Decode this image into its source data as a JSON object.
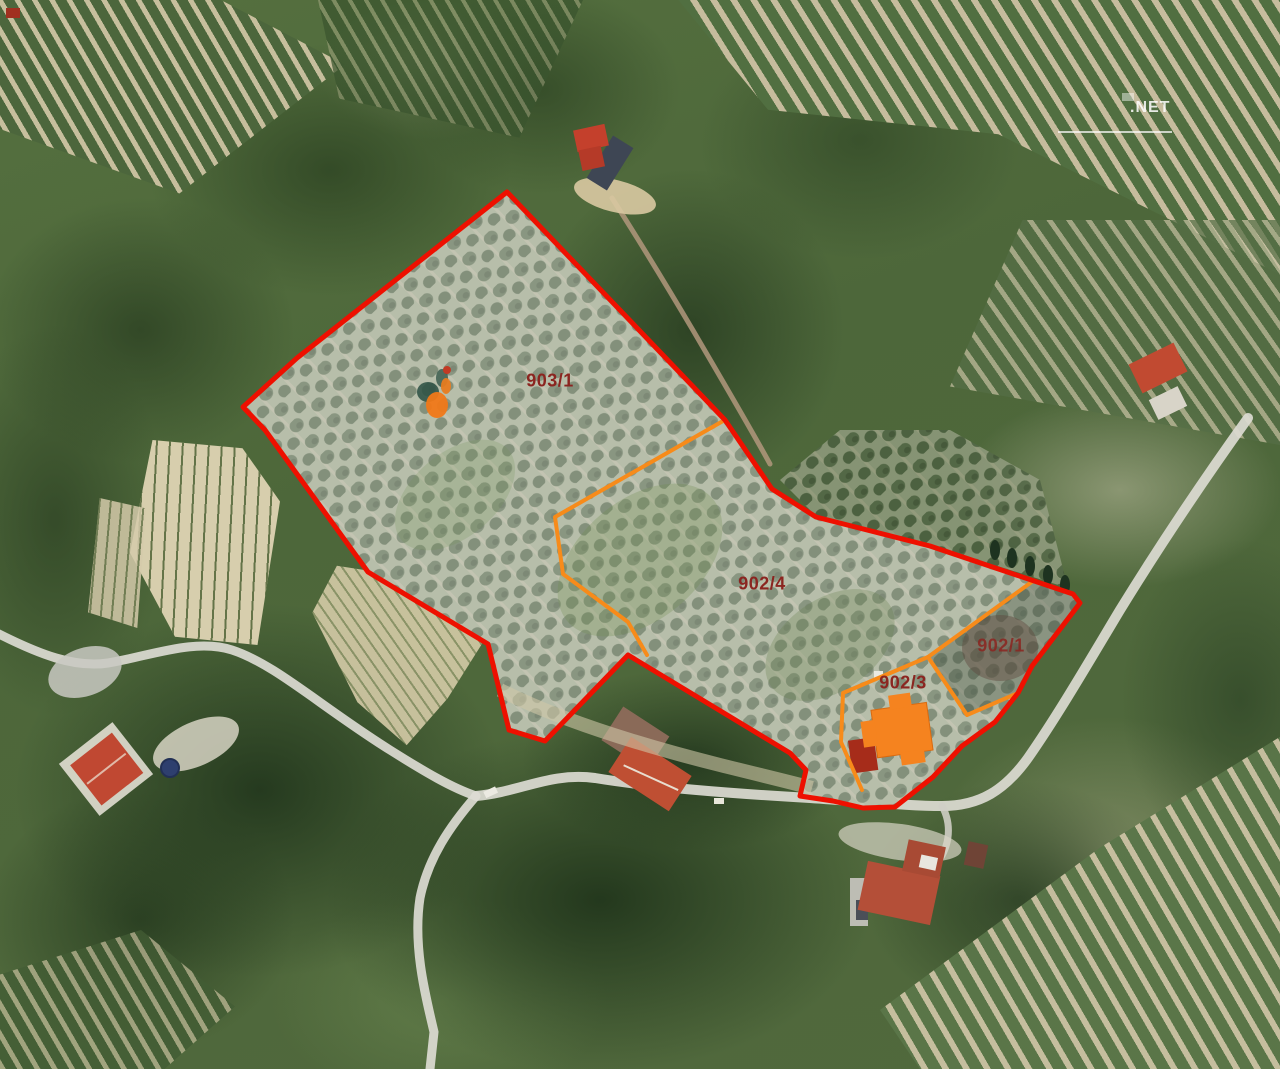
{
  "map": {
    "watermark_text": ".NET",
    "labels": {
      "p903_1": "903/1",
      "p902_4": "902/4",
      "p902_1": "902/1",
      "p902_3": "902/3"
    },
    "colors": {
      "primary_boundary": "#ee1000",
      "secondary_boundary": "#f78b1a",
      "parcel_label": "#8b2520",
      "building_fill": "#f5831f",
      "building_annex": "#a62c1a"
    }
  }
}
